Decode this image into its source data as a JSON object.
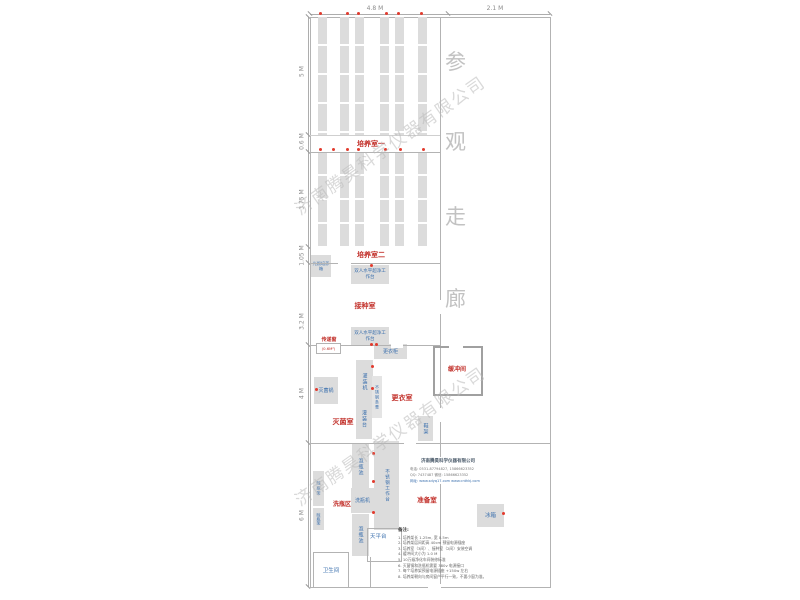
{
  "plan": {
    "top_dims": [
      "4.8 M",
      "2.1 M"
    ],
    "left_dims": [
      "5 M",
      "0.6 M",
      "3.75 M",
      "1.05 M",
      "3.2 M",
      "4 M",
      "6 M"
    ],
    "corridor_chars": [
      "参",
      "观",
      "走",
      "廊"
    ],
    "watermark_text": "济南腾昊科学仪器有限公司",
    "rooms": {
      "culture1": "培养室一",
      "culture2": "培养室二",
      "inoculation": "接种室",
      "pass_window": "传递窗",
      "pass_window_size": "(0.6M²)",
      "sterilize": "灭菌室",
      "changing": "更衣室",
      "buffer": "缓冲间",
      "washing": "洗瓶区",
      "prep": "准备室"
    },
    "equipment": {
      "light_incubator": "光照培养箱",
      "bench1": "双人水平超净工作台",
      "bench2": "双人水平超净工作台",
      "wardrobe": "更衣柜",
      "filling_machine": "灌装机",
      "steel_bench": "不锈钢条凳",
      "sterilizer_pot": "灭菌锅",
      "filling_table": "灌装台",
      "shoe_rack": "鞋架",
      "soak_pool1": "泡瓶池",
      "steel_worktable": "不锈钢工作台",
      "bottle_washer": "洗瓶机",
      "dry_rack1": "晾瓶架",
      "dry_rack2": "晾瓶架",
      "soak_pool2": "泡瓶池",
      "balance_table": "天平台",
      "toilet": "卫生间",
      "fridge": "冰箱"
    },
    "info_block": {
      "company": "济南腾昊科学仪器有限公司",
      "phone_line": "电话: 0531-87794827, 15866623352",
      "qq_line": "QQ: 7437487  微信: 15866623352",
      "web_line": "网址: www.sdyq17.com  www.cnthkj.com"
    },
    "notes": {
      "title": "备注:",
      "items": [
        "1. 培养架长 1.25m, 宽 0.5m",
        "2. 培养架层间距高 40cm 预留电源插座",
        "3. 培养室（3间）、接种室（2间）安装空调",
        "4. 缓冲间大小为 1.0 M",
        "5. 10万级净化车间装修标准",
        "6. 灭菌锅和洗瓶机需要 380v 电源接口",
        "7. 每个培养架预留电源插座 +150w 左右",
        "8. 培养架朝向与房间窗户平行一致，不要小窗为准。"
      ]
    },
    "colors": {
      "label_red": "#c2302a",
      "label_blue": "#3a6fad",
      "furniture_gray": "#dcdcdc",
      "wall_gray": "#b3b3b3",
      "dot_red": "#e23b2e",
      "watermark_gray": "#b9b9b9"
    }
  }
}
